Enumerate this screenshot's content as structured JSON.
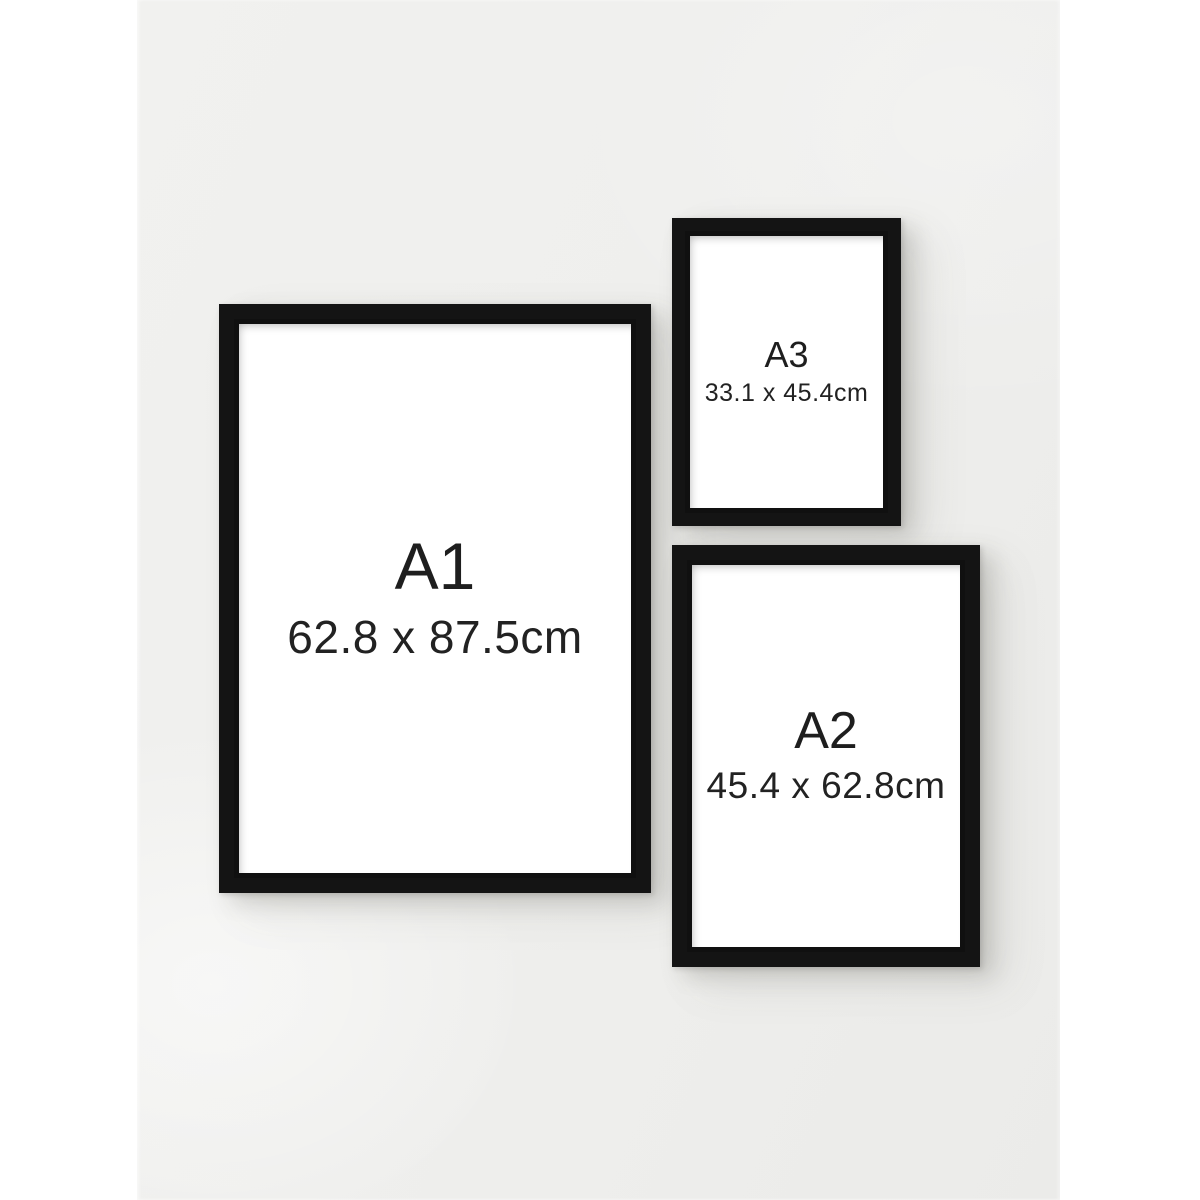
{
  "frames": [
    {
      "label": "A1",
      "dimensions": "62.8 x 87.5cm"
    },
    {
      "label": "A3",
      "dimensions": "33.1 x 45.4cm"
    },
    {
      "label": "A2",
      "dimensions": "45.4 x 62.8cm"
    }
  ],
  "colors": {
    "wall": "#efefed",
    "page_margin": "#ffffff",
    "frame": "#141414",
    "frame_interior": "#ffffff",
    "text": "#1e1e1e"
  }
}
